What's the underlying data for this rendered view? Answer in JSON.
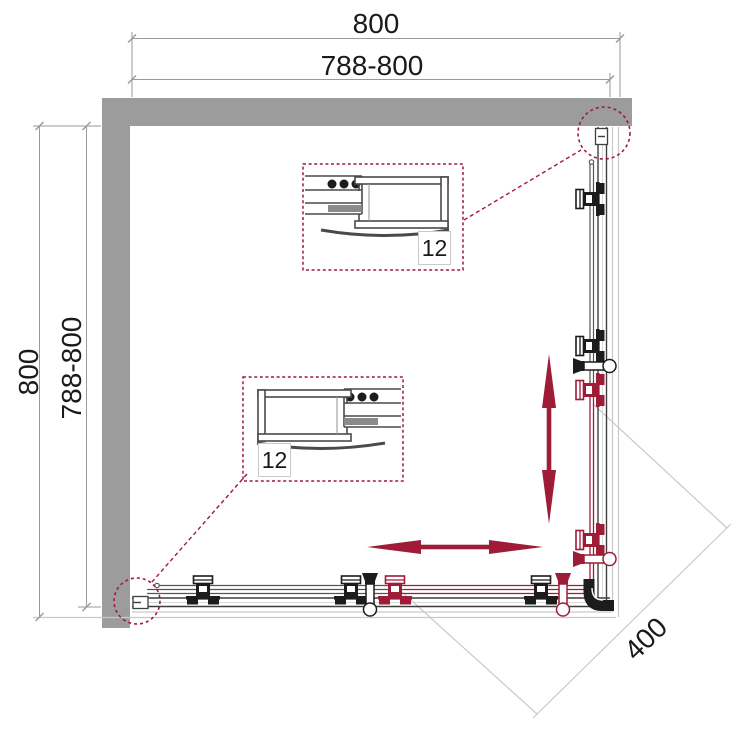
{
  "dimensions": {
    "top": {
      "overall": "800",
      "range": "788-800"
    },
    "left": {
      "overall": "800",
      "range": "788-800"
    },
    "diagonal": "400"
  },
  "callouts": {
    "upper": {
      "label": "12"
    },
    "lower": {
      "label": "12"
    }
  },
  "colors": {
    "accent": "#9e1c38",
    "wall": "#9c9c9c",
    "line": "#3f3f3f",
    "glass": "#555555",
    "light": "#c9c9c9",
    "dim": "#9a9a9a",
    "text": "#1a1a1a",
    "detail": "#4a4a4a",
    "black": "#1c1c1c"
  }
}
